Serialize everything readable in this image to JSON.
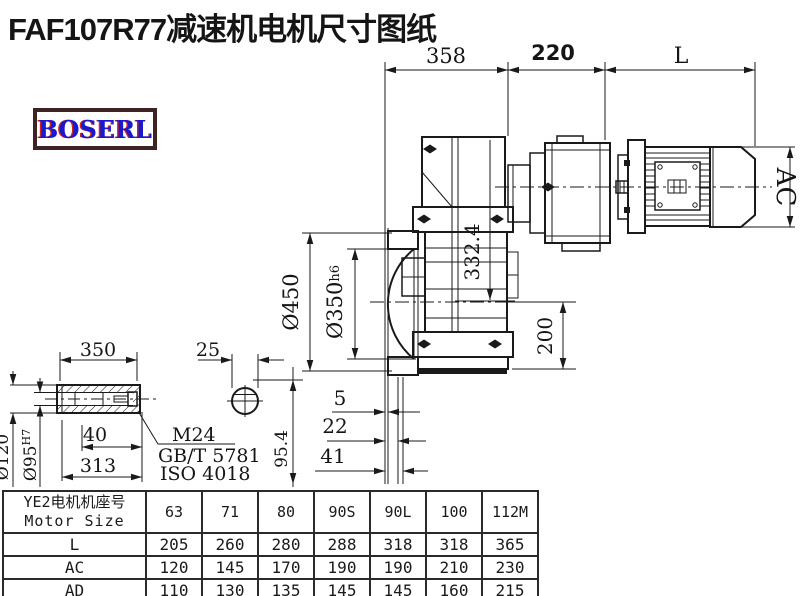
{
  "title": "FAF107R77减速机电机尺寸图纸",
  "logo": {
    "text": "BOSERL"
  },
  "drawing": {
    "dims": {
      "d358": "358",
      "d220": "220",
      "dL": "L",
      "dAC": "AC",
      "d450": "Ø450",
      "d350": "Ø350",
      "d350_suffix": "h6",
      "d332": "332.4",
      "d200": "200",
      "d5": "5",
      "d22": "22",
      "d41": "41",
      "s350": "350",
      "s40": "40",
      "s313": "313",
      "d120": "Ø120",
      "d95": "Ø95",
      "d95_sup": "H7",
      "k25": "25",
      "k954": "95.4",
      "thread": "M24",
      "std1": "GB/T 5781",
      "std2": "ISO 4018"
    },
    "colors": {
      "line": "#1a1a1a",
      "logo_border": "#3d2323",
      "logo_text": "#1a1acc",
      "logo_shadow": "#cc2222"
    }
  },
  "table": {
    "header": {
      "line1": "YE2电机机座号",
      "line2": "Motor Size",
      "columns": [
        "63",
        "71",
        "80",
        "90S",
        "90L",
        "100",
        "112M"
      ]
    },
    "rows": [
      {
        "label": "L",
        "values": [
          "205",
          "260",
          "280",
          "288",
          "318",
          "318",
          "365"
        ]
      },
      {
        "label": "AC",
        "values": [
          "120",
          "145",
          "170",
          "190",
          "190",
          "210",
          "230"
        ]
      },
      {
        "label": "AD",
        "values": [
          "110",
          "130",
          "135",
          "145",
          "145",
          "160",
          "215"
        ]
      }
    ]
  }
}
